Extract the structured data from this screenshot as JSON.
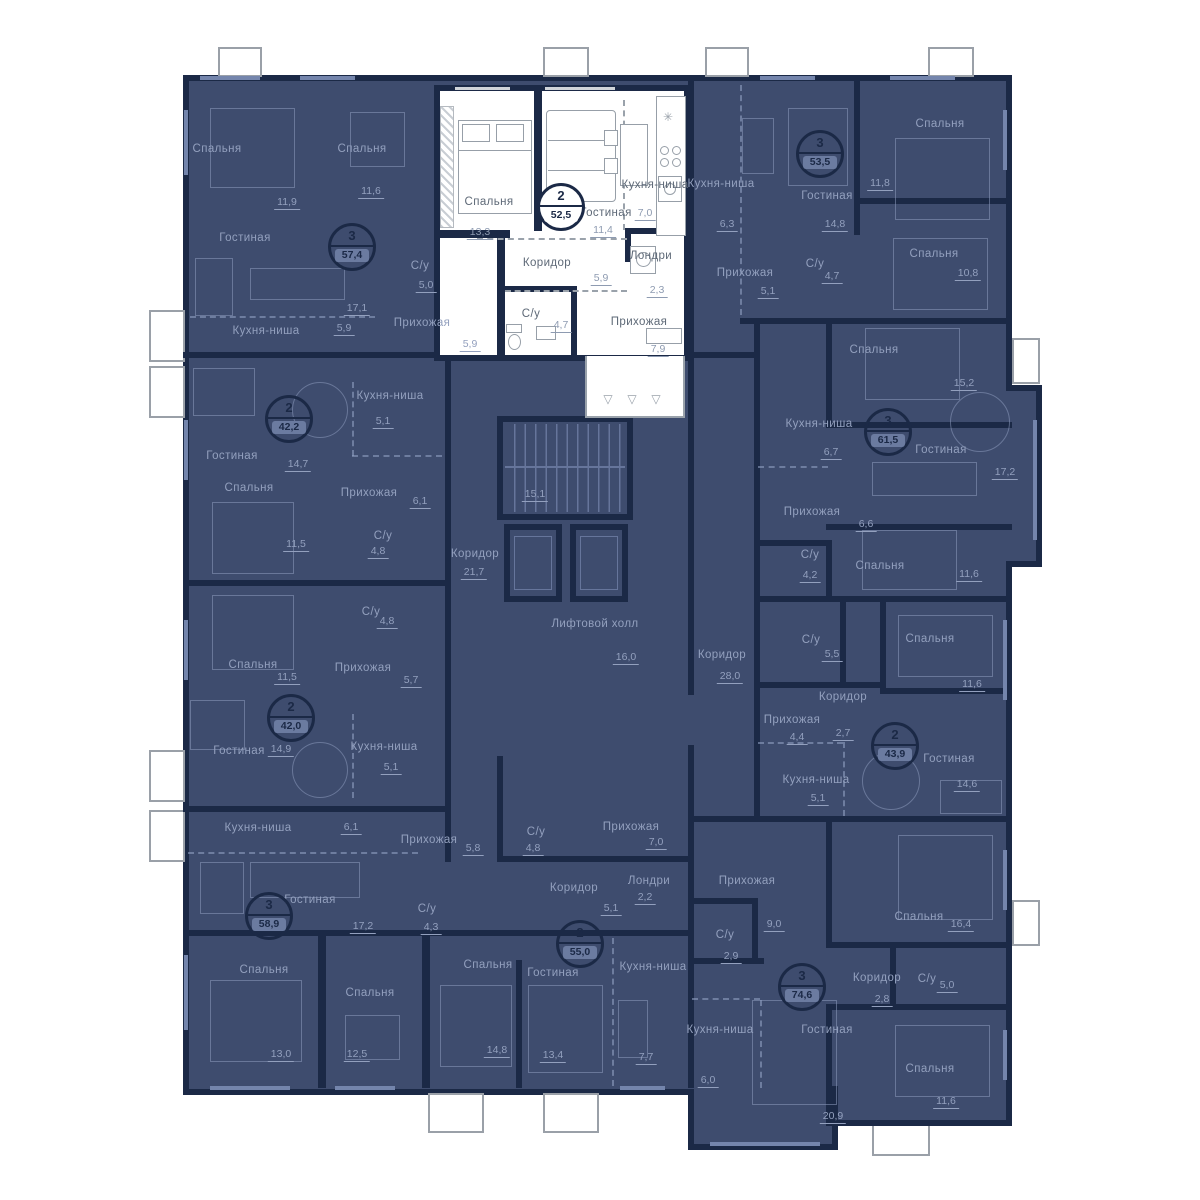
{
  "icons": {
    "vent": "✳",
    "hook": "▽"
  },
  "common": {
    "stairs_area": "15,1",
    "corridor_left": {
      "n": "Коридор",
      "a": "21,7"
    },
    "lift_hall": {
      "n": "Лифтовой холл",
      "a": "16,0"
    },
    "corridor_right": {
      "n": "Коридор",
      "a": "28,0"
    }
  },
  "units": [
    {
      "badge": {
        "rooms": "2",
        "area": "52,5"
      },
      "highlighted": true,
      "rooms": [
        {
          "n": "Спальня",
          "a": "13,3"
        },
        {
          "n": "Гостиная",
          "a": "11,4"
        },
        {
          "n": "Кухня-ниша",
          "a": "7,0"
        },
        {
          "n": "Коридор",
          "a": "5,9"
        },
        {
          "n": "Лондри",
          "a": "2,3"
        },
        {
          "n": "С/у",
          "a": "4,7"
        },
        {
          "n": "Прихожая",
          "a": "7,9"
        }
      ]
    },
    {
      "badge": {
        "rooms": "3",
        "area": "57,4"
      },
      "highlighted": false,
      "rooms": [
        {
          "n": "Спальня",
          "a": "11,9"
        },
        {
          "n": "Спальня",
          "a": "11,6"
        },
        {
          "n": "Гостиная",
          "a": "17,1"
        },
        {
          "n": "С/у",
          "a": "5,0"
        },
        {
          "n": "Кухня-ниша",
          "a": "5,9"
        },
        {
          "n": "Прихожая",
          "a": "5,9"
        }
      ]
    },
    {
      "badge": {
        "rooms": "2",
        "area": "42,2"
      },
      "highlighted": false,
      "rooms": [
        {
          "n": "Гостиная",
          "a": "14,7"
        },
        {
          "n": "Кухня-ниша",
          "a": "5,1"
        },
        {
          "n": "Спальня",
          "a": "11,5"
        },
        {
          "n": "С/у",
          "a": "4,8"
        },
        {
          "n": "Прихожая",
          "a": "6,1"
        }
      ]
    },
    {
      "badge": {
        "rooms": "2",
        "area": "42,0"
      },
      "highlighted": false,
      "rooms": [
        {
          "n": "Спальня",
          "a": "11,5"
        },
        {
          "n": "С/у",
          "a": "4,8"
        },
        {
          "n": "Прихожая",
          "a": "5,7"
        },
        {
          "n": "Гостиная",
          "a": "14,9"
        },
        {
          "n": "Кухня-ниша",
          "a": "5,1"
        }
      ]
    },
    {
      "badge": {
        "rooms": "3",
        "area": "58,9"
      },
      "highlighted": false,
      "rooms": [
        {
          "n": "Кухня-ниша",
          "a": "6,1"
        },
        {
          "n": "Прихожая",
          "a": "5,8"
        },
        {
          "n": "Гостиная",
          "a": "17,2"
        },
        {
          "n": "С/у",
          "a": "4,3"
        },
        {
          "n": "Спальня",
          "a": "13,0"
        },
        {
          "n": "Спальня",
          "a": "12,5"
        }
      ]
    },
    {
      "badge": {
        "rooms": "2",
        "area": "55,0"
      },
      "highlighted": false,
      "rooms": [
        {
          "n": "С/у",
          "a": "4,8"
        },
        {
          "n": "Коридор",
          "a": "5,1"
        },
        {
          "n": "Лондри",
          "a": "2,2"
        },
        {
          "n": "Прихожая",
          "a": "7,0"
        },
        {
          "n": "Спальня",
          "a": "14,8"
        },
        {
          "n": "Гостиная",
          "a": "13,4"
        },
        {
          "n": "Кухня-ниша",
          "a": "7,7"
        }
      ]
    },
    {
      "badge": {
        "rooms": "3",
        "area": "53,5"
      },
      "highlighted": false,
      "rooms": [
        {
          "n": "Кухня-ниша",
          "a": "6,3"
        },
        {
          "n": "Спальня",
          "a": "11,8"
        },
        {
          "n": "Гостиная",
          "a": "14,8"
        },
        {
          "n": "Прихожая",
          "a": "5,1"
        },
        {
          "n": "С/у",
          "a": "4,7"
        },
        {
          "n": "Спальня",
          "a": "10,8"
        }
      ]
    },
    {
      "badge": {
        "rooms": "3",
        "area": "61,5"
      },
      "highlighted": false,
      "rooms": [
        {
          "n": "Спальня",
          "a": "15,2"
        },
        {
          "n": "Кухня-ниша",
          "a": "6,7"
        },
        {
          "n": "Гостиная",
          "a": "17,2"
        },
        {
          "n": "Прихожая",
          "a": "6,6"
        },
        {
          "n": "С/у",
          "a": "4,2"
        },
        {
          "n": "Спальня",
          "a": "11,6"
        }
      ]
    },
    {
      "badge": {
        "rooms": "2",
        "area": "43,9"
      },
      "highlighted": false,
      "rooms": [
        {
          "n": "С/у",
          "a": "5,5"
        },
        {
          "n": "Коридор",
          "a": "2,7"
        },
        {
          "n": "Спальня",
          "a": "11,6"
        },
        {
          "n": "Прихожая",
          "a": "4,4"
        },
        {
          "n": "Кухня-ниша",
          "a": "5,1"
        },
        {
          "n": "Гостиная",
          "a": "14,6"
        }
      ]
    },
    {
      "badge": {
        "rooms": "3",
        "area": "74,6"
      },
      "highlighted": false,
      "rooms": [
        {
          "n": "Прихожая",
          "a": "9,0"
        },
        {
          "n": "С/у",
          "a": "2,9"
        },
        {
          "n": "Спальня",
          "a": "16,4"
        },
        {
          "n": "Коридор",
          "a": "2,8"
        },
        {
          "n": "С/у",
          "a": "5,0"
        },
        {
          "n": "Кухня-ниша",
          "a": "6,0"
        },
        {
          "n": "Гостиная",
          "a": "20,9"
        },
        {
          "n": "Спальня",
          "a": "11,6"
        }
      ]
    }
  ]
}
